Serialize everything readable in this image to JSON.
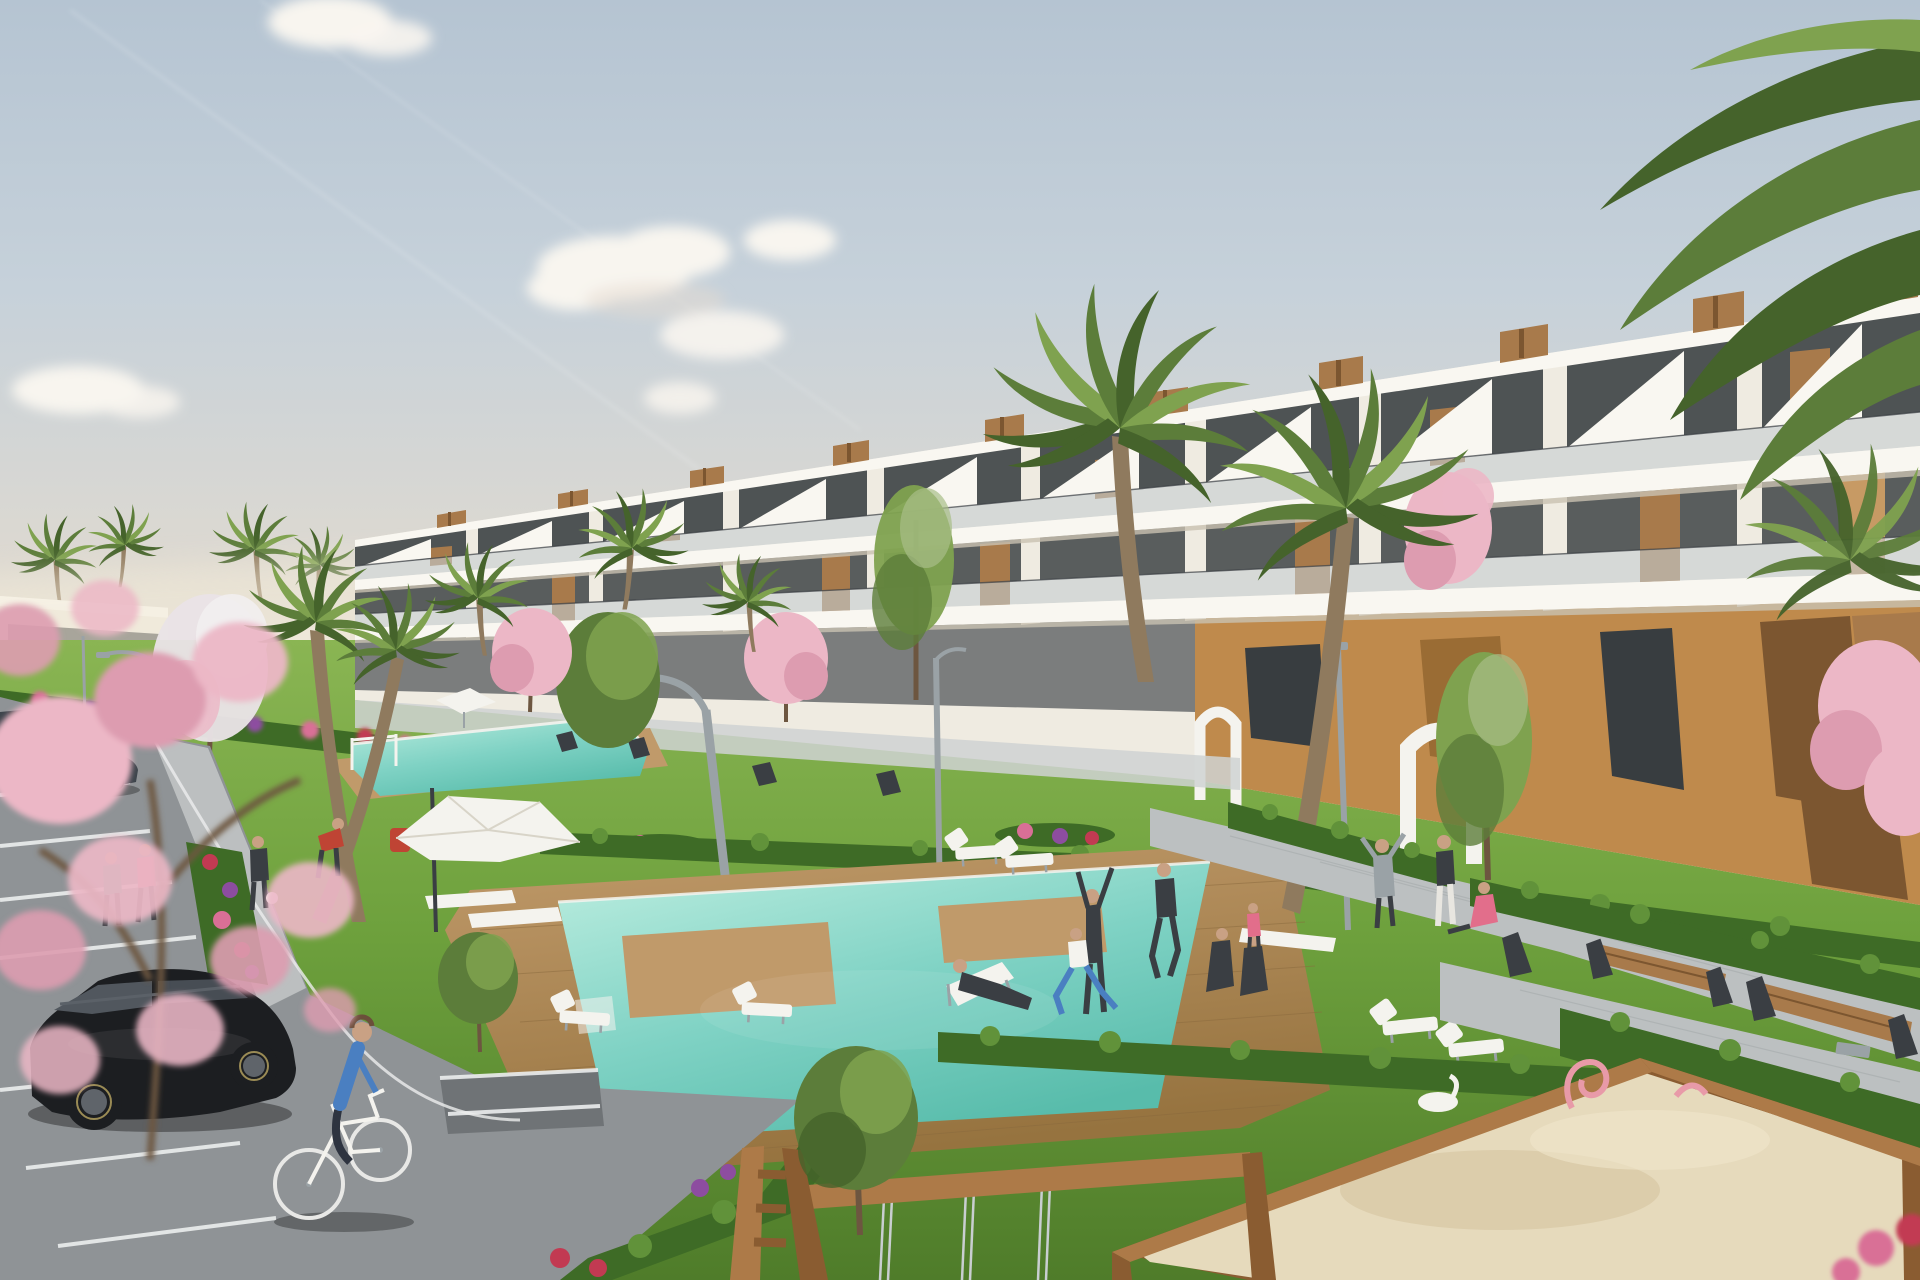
{
  "scene": {
    "type": "3d-architectural-rendering",
    "subject": "modern white terraced apartment complex with landscaped pool gardens",
    "sky": {
      "clouds": [
        "cumulus-cluster-center",
        "small-cloud-top-left",
        "small-cloud-lower-left"
      ],
      "contrails": 2
    },
    "buildings": {
      "main_block": {
        "floors": 3,
        "style": "white stepped terraces, glass balustrades, wood-slat roof cabins, stair parapets",
        "ground_floor": "ochre walls with timber panels and white arched portals"
      },
      "distant_left": "low white building strip with dark glazing"
    },
    "landscape": {
      "pools": [
        "upper garden pool",
        "large main pool with timber deck islands"
      ],
      "hedges": "clipped boxwood rows",
      "flowers": [
        "red",
        "pink",
        "purple"
      ],
      "trees": [
        "palms",
        "pink cherry blossoms",
        "white blossom tree",
        "green poplars",
        "olives"
      ]
    },
    "amenities": [
      "white parasol",
      "small white tent",
      "sun loungers",
      "white garden benches",
      "timber benches with steel wedge legs",
      "curved street lamps",
      "children sandbox with pink toys and white swan rocker",
      "wooden swing frame with chains"
    ],
    "vehicles": [
      "black hatchback parked",
      "dark sedan",
      "dark car at lot edge"
    ],
    "people": [
      "cyclist in blue sweater",
      "jogger in teal",
      "jogger in pink",
      "walker with football",
      "man in red bending",
      "man reclining on lounger",
      "stretching man",
      "runner in black",
      "woman lunging in blue leggings",
      "seated couple on lawn",
      "man with raised arms",
      "standing woman",
      "woman seated in pink",
      "child in pink"
    ]
  },
  "palette": {
    "sky_top": "#b5c4d2",
    "sky_mid": "#c6d1da",
    "sky_low": "#ddd9d1",
    "horizon": "#ece5d8",
    "cloud": "#f8f5ef",
    "bldg": "#efebe1",
    "bldg_shade": "#e0dacc",
    "slab": "#f9f7f1",
    "slab_shadow": "#c9c2b2",
    "glass": "#383d40",
    "glass_dim": "#4a4f52",
    "balustrade": "#c4cdd1",
    "wood": "#a87a4b",
    "wood_dark": "#7c5630",
    "wood_light": "#c79a64",
    "tan": "#bf8a4c",
    "tan_dark": "#9a6c34",
    "grass_hi": "#8ab553",
    "grass": "#6ea13d",
    "grass_lo": "#4f7c2a",
    "hedge": "#3e6b26",
    "hedge_hi": "#61923a",
    "flower_red": "#c23a52",
    "flower_pink": "#d96f96",
    "flower_purple": "#8d4da0",
    "blossom": "#ecb7c6",
    "blossom_deep": "#dd9cb0",
    "pool_hi": "#bdeee0",
    "pool": "#7fd2c4",
    "pool_lo": "#58bcab",
    "deck": "#c09a6a",
    "deck_dark": "#96733f",
    "path": "#bcc0c1",
    "path_hi": "#cfd2d2",
    "asphalt": "#8f9396",
    "asphalt_dark": "#6f7376",
    "stall_line": "#eceeee",
    "trunk": "#8f7a5e",
    "palm": "#5c7d3a",
    "palm_dark": "#45632b",
    "palm_light": "#7fa24f",
    "car_black": "#1c1e21",
    "car_grey": "#3d444b",
    "metal": "#9aa2a6",
    "sand": "#e6dabc",
    "sand_shade": "#d2c09a",
    "timber": "#ad7a48",
    "timber_dark": "#8a5c31",
    "white": "#f4f3ee",
    "dark": "#3a3e43",
    "skin": "#c9a184",
    "blue": "#4a7fc1",
    "red": "#bf4434",
    "pinkc": "#e26e8b",
    "teal": "#52a08e",
    "chain": "#c9ced1",
    "twig": "#6d5640"
  }
}
